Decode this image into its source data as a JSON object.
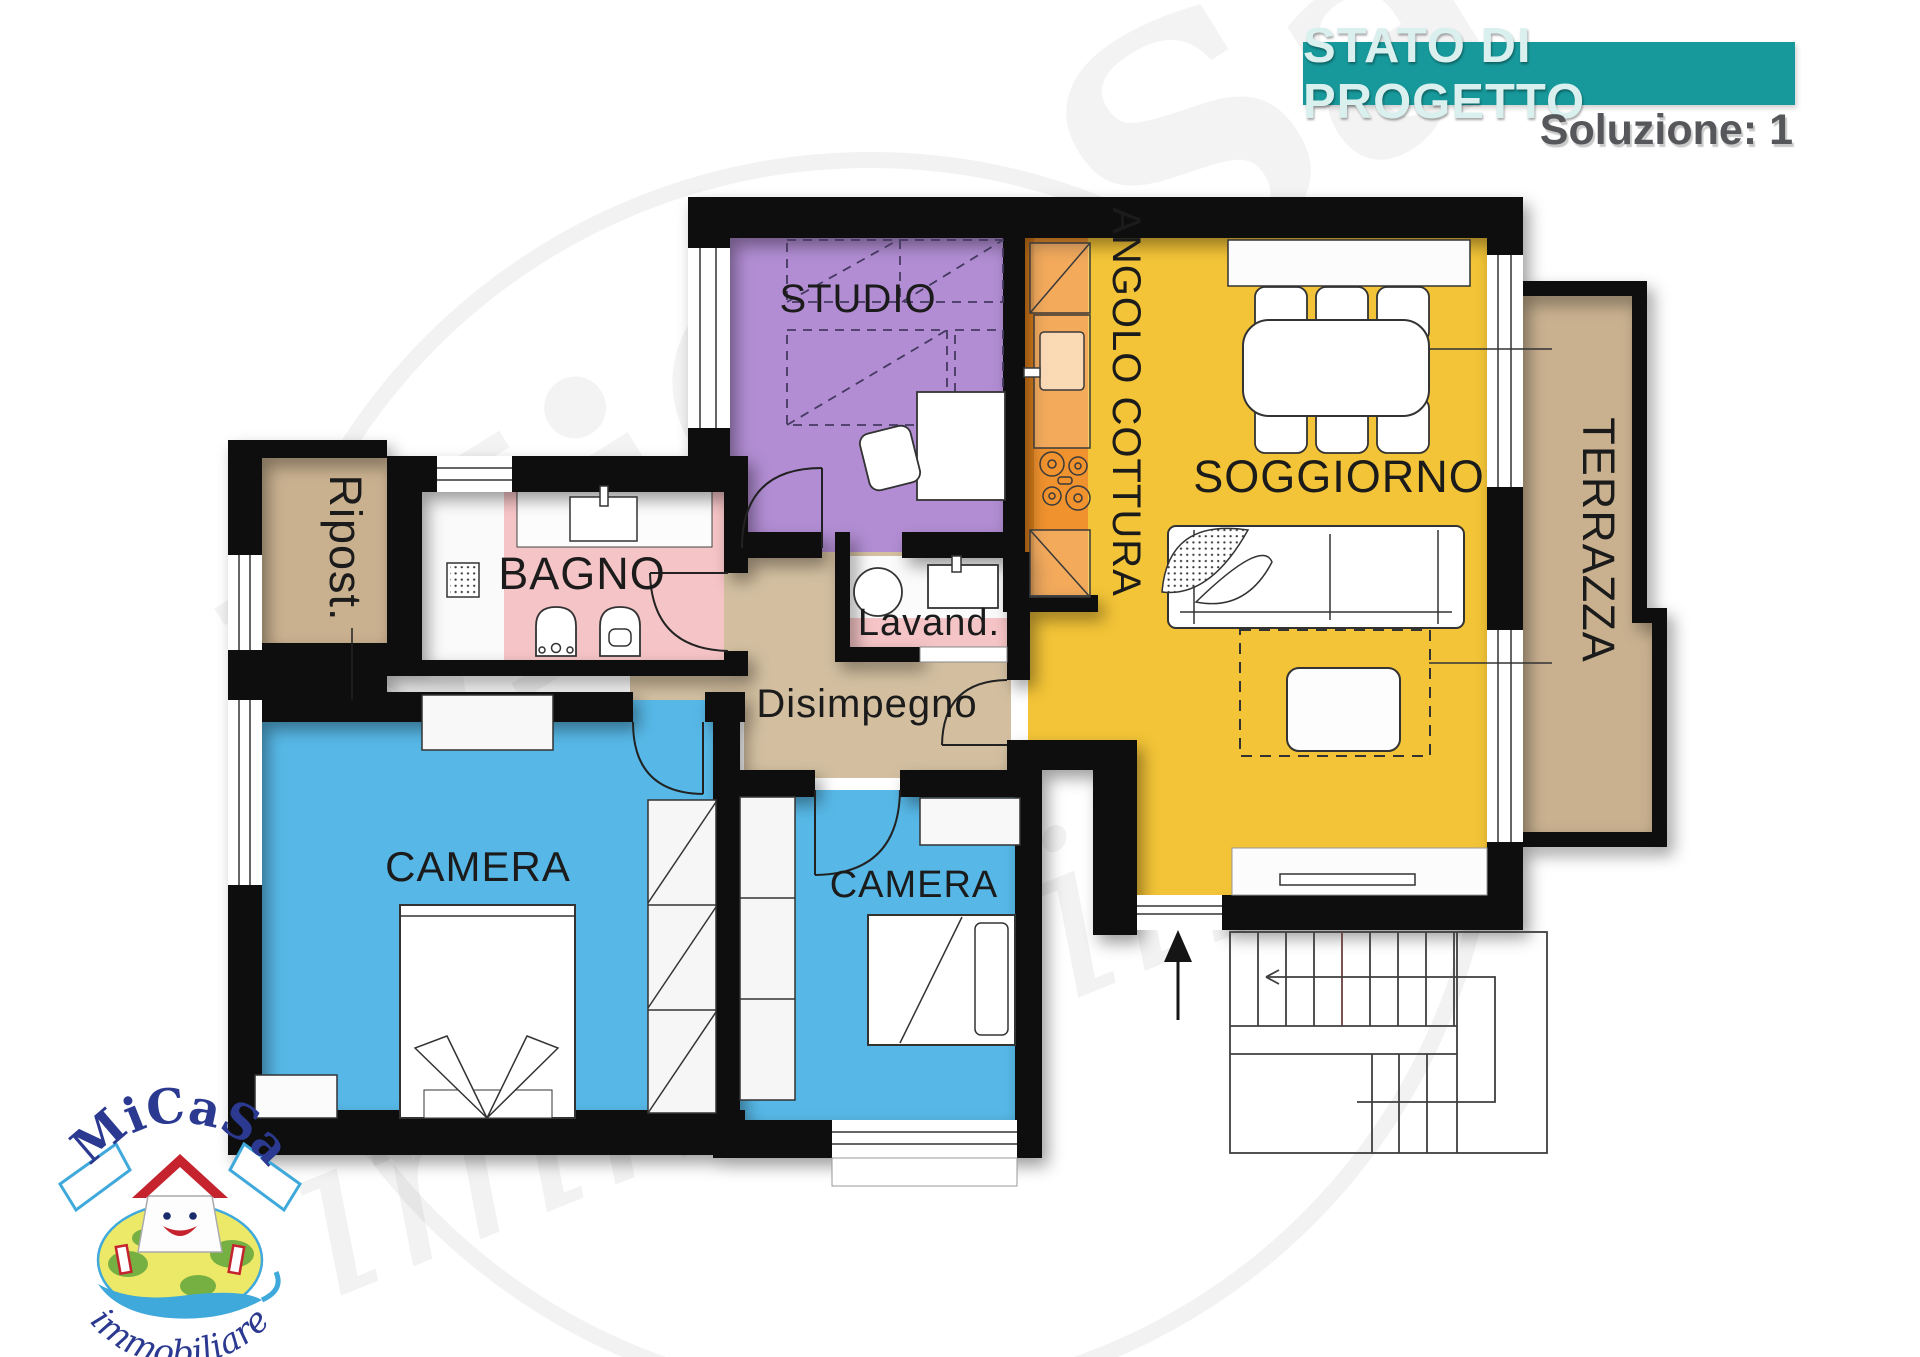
{
  "header": {
    "title": "STATO DI PROGETTO",
    "subtitle": "Soluzione: 1",
    "bar_color": "#17989a"
  },
  "logo": {
    "brand": "MiCaSa",
    "tagline": "immobiliare"
  },
  "watermark": {
    "brand": "MiCaSa",
    "tagline": "immobiliare"
  },
  "plan": {
    "wall_color": "#0e0e0e",
    "rooms": [
      {
        "id": "studio",
        "label": "STUDIO",
        "color": "#b28dd3"
      },
      {
        "id": "angolo_cottura",
        "label": "ANGOLO COTTURA",
        "color": "#f0922e"
      },
      {
        "id": "soggiorno",
        "label": "SOGGIORNO",
        "color": "#f3c437"
      },
      {
        "id": "terrazza",
        "label": "TERRAZZA",
        "color": "#c9b190"
      },
      {
        "id": "ripostiglio",
        "label": "Ripost.",
        "color": "#c9b190"
      },
      {
        "id": "bagno",
        "label": "BAGNO",
        "color": "#f5c4c6"
      },
      {
        "id": "lavanderia",
        "label": "Lavand.",
        "color": "#f5c4c6"
      },
      {
        "id": "disimpegno",
        "label": "Disimpegno",
        "color": "#d3bfa0"
      },
      {
        "id": "camera_matrimoniale",
        "label": "CAMERA",
        "color": "#57b8e7"
      },
      {
        "id": "camera_singola",
        "label": "CAMERA",
        "color": "#57b8e7"
      }
    ]
  }
}
